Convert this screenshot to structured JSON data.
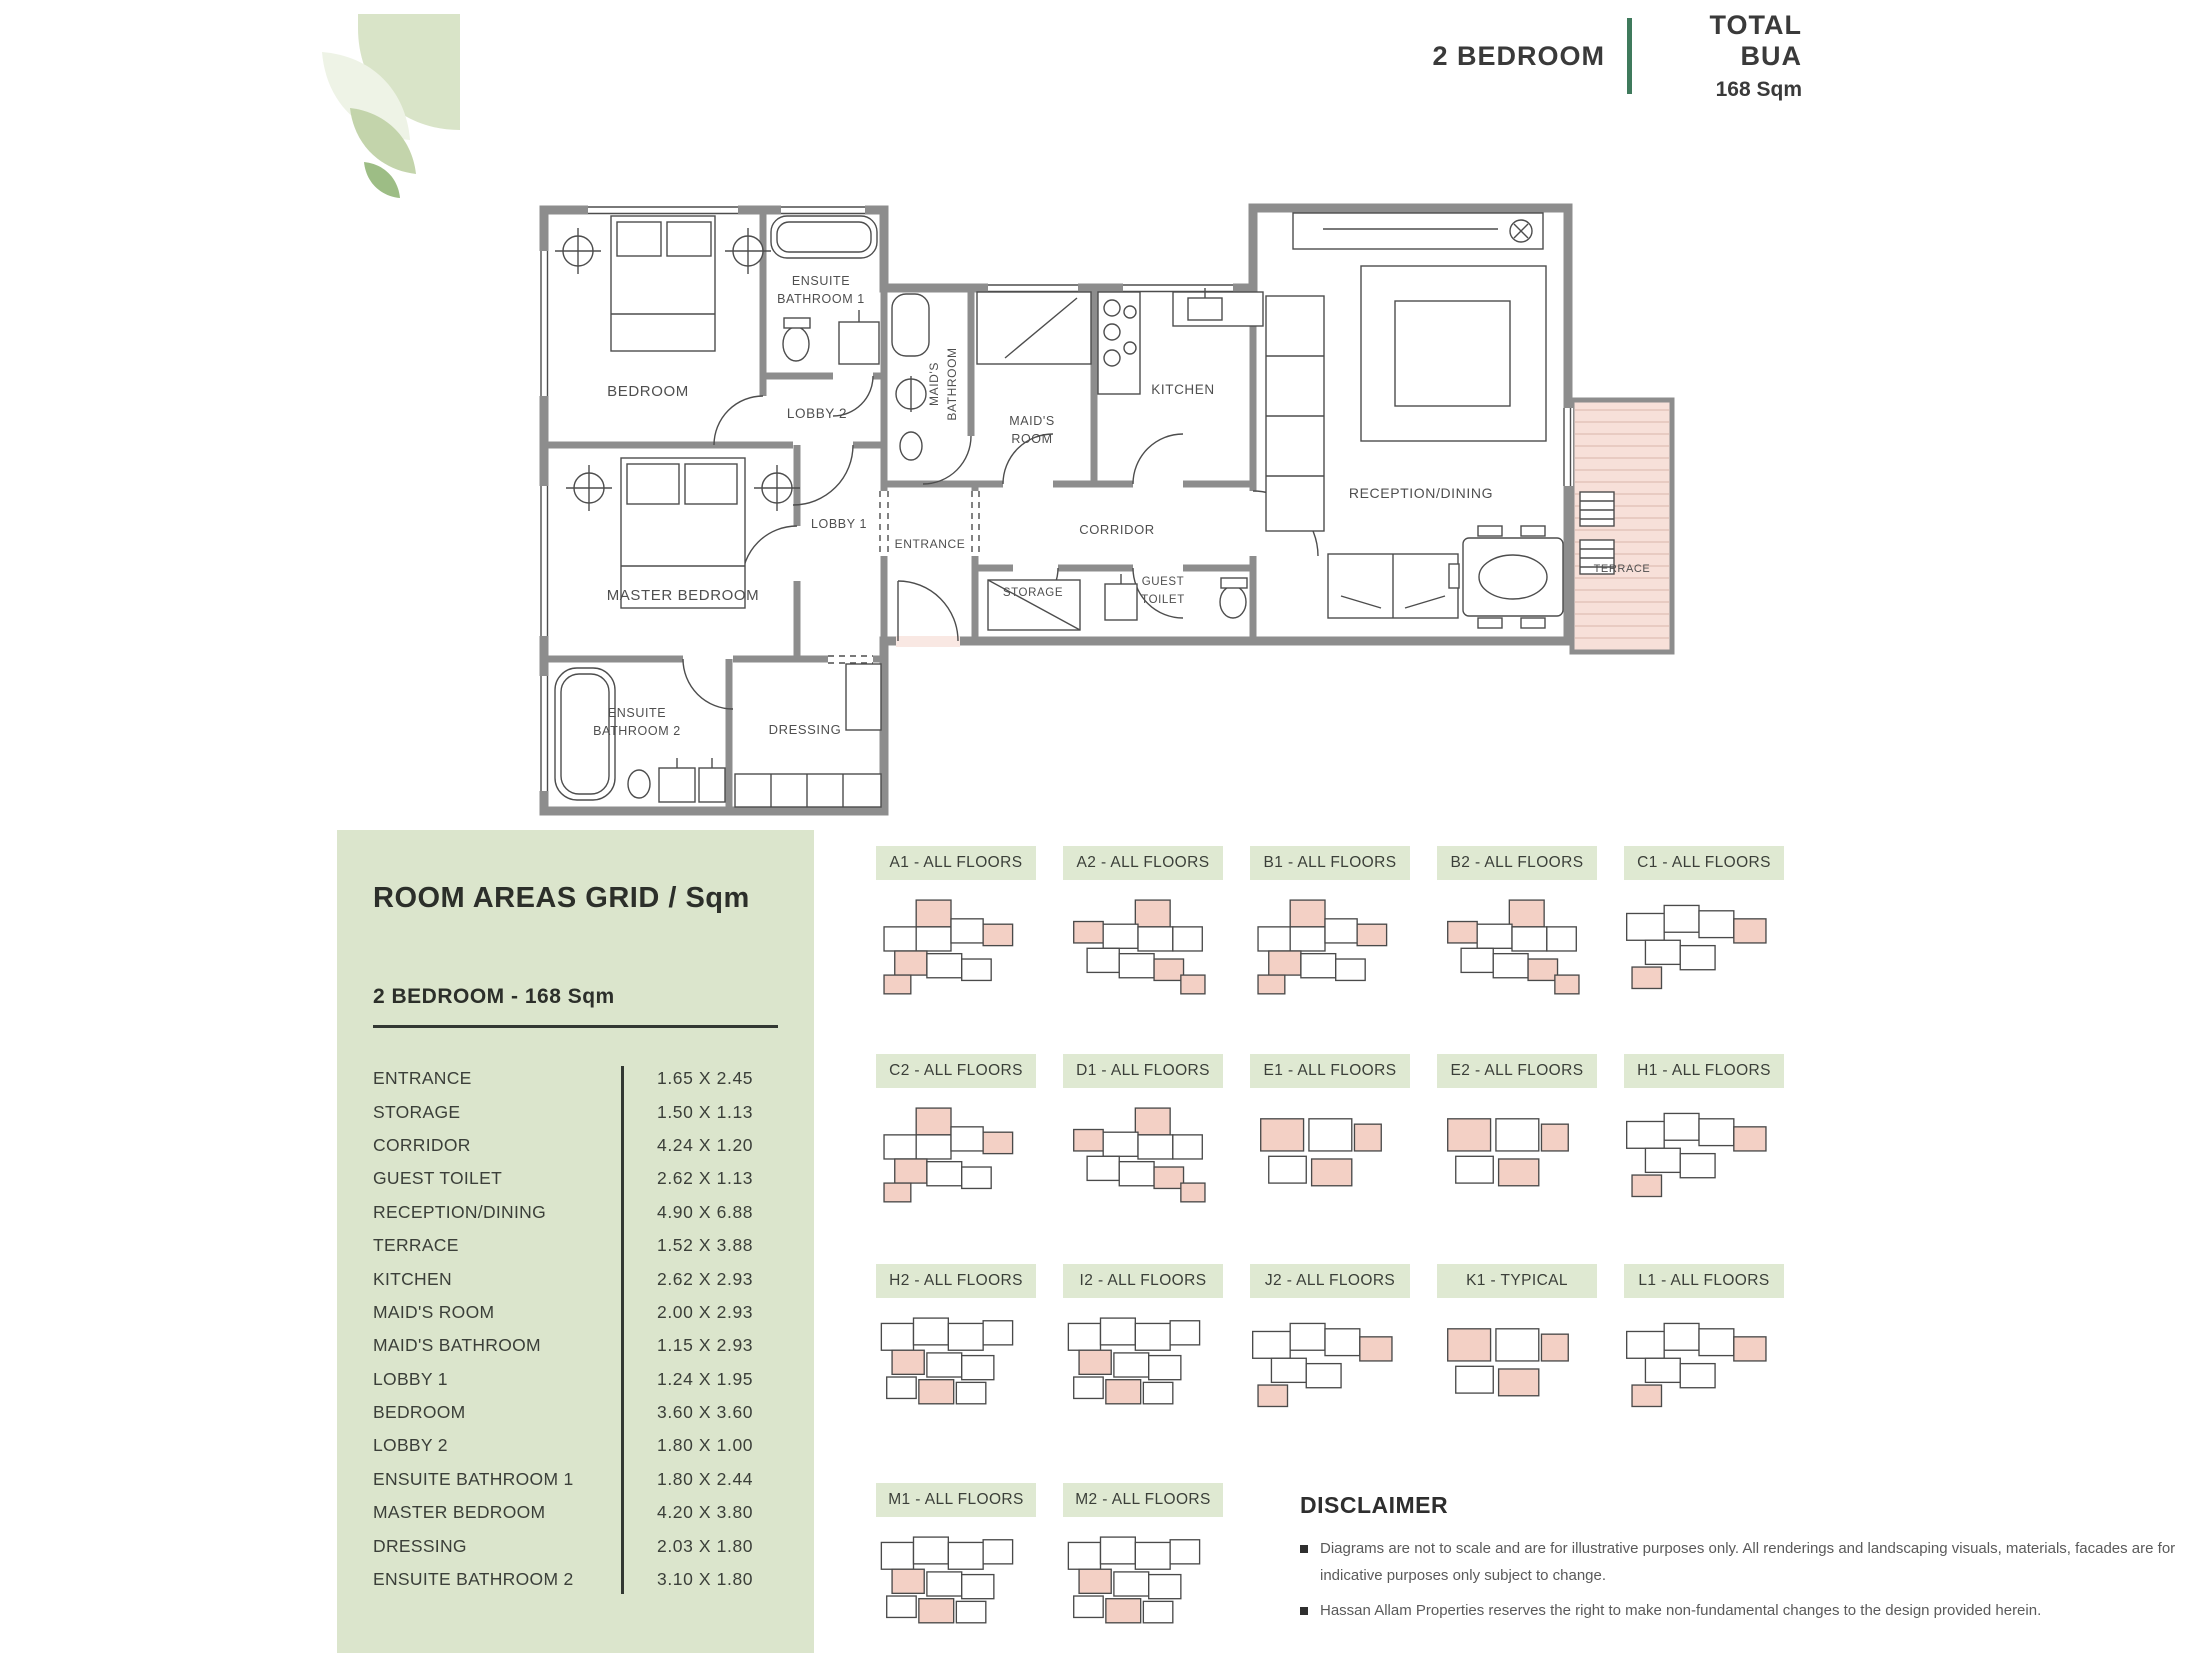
{
  "header": {
    "unit_type": "2 BEDROOM",
    "bua_label": "TOTAL BUA",
    "bua_value": "168 Sqm"
  },
  "colors": {
    "accent_green": "#3f7a5c",
    "panel_green": "#dbe5cc",
    "chip_green": "#dfe9d2",
    "room_pink": "#f9e8e3",
    "wall_gray": "#8d8d8d"
  },
  "floor_plan": {
    "rooms": [
      {
        "id": "bedroom",
        "label": "BEDROOM"
      },
      {
        "id": "ensuite1",
        "label": "ENSUITE BATHROOM 1"
      },
      {
        "id": "lobby2",
        "label": "LOBBY 2"
      },
      {
        "id": "maids_bathroom",
        "label": "MAID'S BATHROOM"
      },
      {
        "id": "maids_room",
        "label": "MAID'S ROOM"
      },
      {
        "id": "kitchen",
        "label": "KITCHEN"
      },
      {
        "id": "reception",
        "label": "RECEPTION/DINING"
      },
      {
        "id": "terrace",
        "label": "TERRACE"
      },
      {
        "id": "lobby1",
        "label": "LOBBY 1"
      },
      {
        "id": "entrance",
        "label": "ENTRANCE"
      },
      {
        "id": "corridor",
        "label": "CORRIDOR"
      },
      {
        "id": "storage",
        "label": "STORAGE"
      },
      {
        "id": "guest_toilet",
        "label": "GUEST TOILET"
      },
      {
        "id": "master_bedroom",
        "label": "MASTER BEDROOM"
      },
      {
        "id": "ensuite2",
        "label": "ENSUITE BATHROOM 2"
      },
      {
        "id": "dressing",
        "label": "DRESSING"
      }
    ]
  },
  "room_areas": {
    "title": "ROOM AREAS GRID / Sqm",
    "subtitle": "2 BEDROOM - 168 Sqm",
    "rows": [
      {
        "room": "ENTRANCE",
        "dims": "1.65 X 2.45"
      },
      {
        "room": "STORAGE",
        "dims": "1.50 X 1.13"
      },
      {
        "room": "CORRIDOR",
        "dims": "4.24 X 1.20"
      },
      {
        "room": "GUEST TOILET",
        "dims": "2.62 X 1.13"
      },
      {
        "room": "RECEPTION/DINING",
        "dims": "4.90 X 6.88"
      },
      {
        "room": "TERRACE",
        "dims": "1.52 X 3.88"
      },
      {
        "room": "KITCHEN",
        "dims": "2.62 X 2.93"
      },
      {
        "room": "MAID'S ROOM",
        "dims": "2.00 X 2.93"
      },
      {
        "room": "MAID'S BATHROOM",
        "dims": "1.15 X 2.93"
      },
      {
        "room": "LOBBY 1",
        "dims": "1.24 X 1.95"
      },
      {
        "room": "BEDROOM",
        "dims": "3.60 X 3.60"
      },
      {
        "room": "LOBBY 2",
        "dims": "1.80 X 1.00"
      },
      {
        "room": "ENSUITE BATHROOM 1",
        "dims": "1.80 X 2.44"
      },
      {
        "room": "MASTER BEDROOM",
        "dims": "4.20 X 3.80"
      },
      {
        "room": "DRESSING",
        "dims": "2.03 X 1.80"
      },
      {
        "room": "ENSUITE BATHROOM 2",
        "dims": "3.10 X 1.80"
      }
    ]
  },
  "unit_diagrams": [
    {
      "label": "A1 - ALL FLOORS"
    },
    {
      "label": "A2 - ALL FLOORS"
    },
    {
      "label": "B1 - ALL FLOORS"
    },
    {
      "label": "B2 - ALL FLOORS"
    },
    {
      "label": "C1 - ALL FLOORS"
    },
    {
      "label": "C2 - ALL FLOORS"
    },
    {
      "label": "D1 - ALL FLOORS"
    },
    {
      "label": "E1 - ALL FLOORS"
    },
    {
      "label": "E2 - ALL FLOORS"
    },
    {
      "label": "H1 - ALL FLOORS"
    },
    {
      "label": "H2 - ALL FLOORS"
    },
    {
      "label": "I2 - ALL FLOORS"
    },
    {
      "label": "J2 - ALL FLOORS"
    },
    {
      "label": "K1 - TYPICAL"
    },
    {
      "label": "L1 - ALL FLOORS"
    },
    {
      "label": "M1 - ALL FLOORS"
    },
    {
      "label": "M2 - ALL FLOORS"
    }
  ],
  "disclaimer": {
    "title": "DISCLAIMER",
    "bullets": [
      "Diagrams are not to scale and are for illustrative purposes only. All renderings and landscaping visuals, materials, facades are for indicative purposes only subject to change.",
      "Hassan Allam Properties reserves the right to make non-fundamental changes to the design provided herein."
    ]
  }
}
